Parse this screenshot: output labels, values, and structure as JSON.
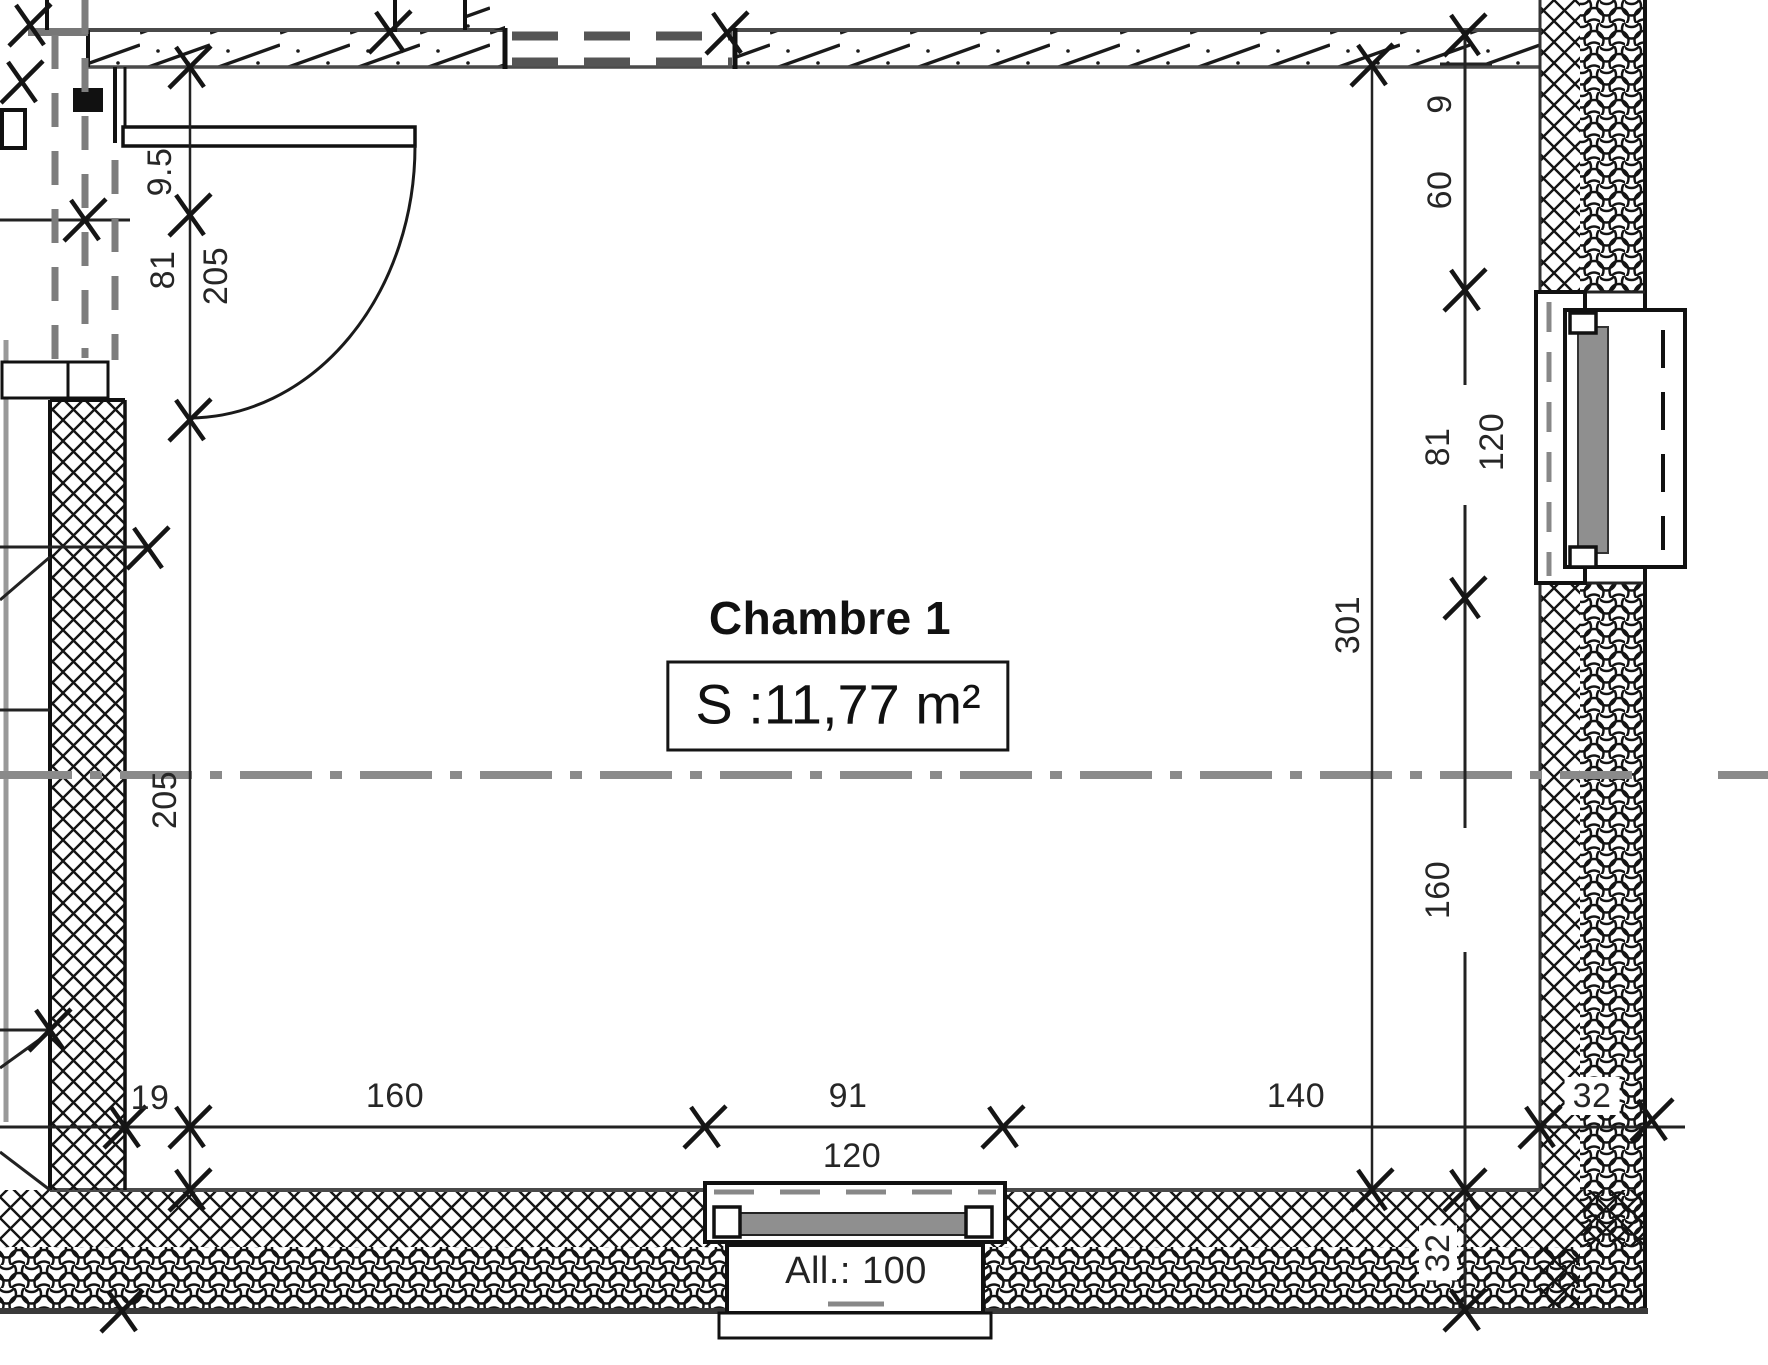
{
  "room": {
    "name": "Chambre 1",
    "area": "S :11,77 m²"
  },
  "door": {
    "dim_offset": "9.5",
    "dim_width": "81",
    "dim_height": "205"
  },
  "left_side": {
    "dim_wall": "205"
  },
  "right_side": {
    "dim_9": "9",
    "dim_60": "60",
    "window_height": "81",
    "window_width": "120",
    "dim_301": "301",
    "dim_160": "160",
    "dim_wall_thickness_v": "32",
    "partial_dim_edge": "35"
  },
  "bottom_side": {
    "dim_19": "19",
    "dim_160": "160",
    "window_width": "91",
    "window_frame": "120",
    "dim_140": "140",
    "dim_wall_thickness_h": "32",
    "window_sill": "All.: 100"
  },
  "colors": {
    "ink": "#1a1a1a",
    "thin_line": "#3a3a3a",
    "gray_line": "#8a8a8a",
    "dashed_partition": "#7d7d7d",
    "sash_fill": "#8f8f8f",
    "background": "#ffffff"
  }
}
